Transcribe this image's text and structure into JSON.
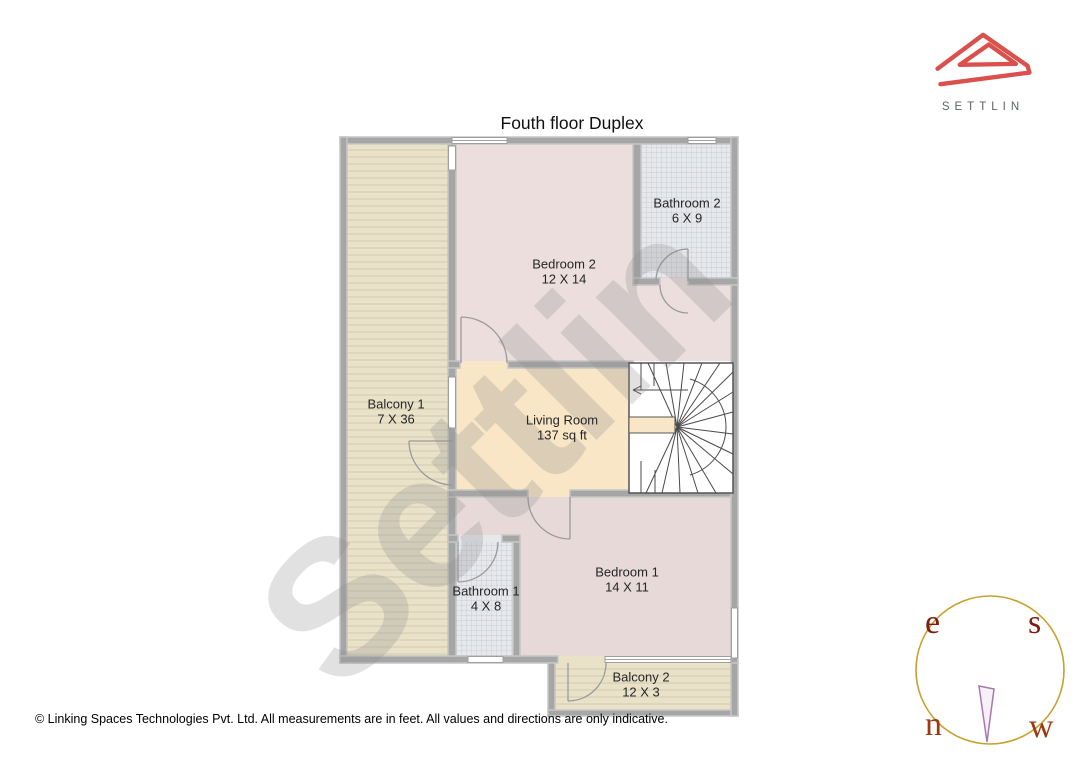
{
  "title": "Fouth floor Duplex",
  "watermark": "Settlin",
  "logo": {
    "brand": "SETTLIN"
  },
  "rooms": [
    {
      "name": "Bathroom 2",
      "dims": "6 X 9"
    },
    {
      "name": "Bedroom 2",
      "dims": "12 X 14"
    },
    {
      "name": "Balcony 1",
      "dims": "7 X 36"
    },
    {
      "name": "Living Room",
      "dims": "137 sq ft"
    },
    {
      "name": "Bathroom 1",
      "dims": "4 X 8"
    },
    {
      "name": "Bedroom 1",
      "dims": "14 X 11"
    },
    {
      "name": "Balcony 2",
      "dims": "12 X 3"
    }
  ],
  "compass": {
    "top_left": "e",
    "top_right": "s",
    "bottom_left": "n",
    "bottom_right": "w"
  },
  "footer": "© Linking Spaces Technologies Pvt. Ltd. All measurements are in feet. All values and directions are only indicative.",
  "colors": {
    "brand_red": "#d9504c",
    "logo_text_gray": "#5e6266",
    "wall_gray": "#a6a6a6",
    "bedroom_pink": "#ecdedd",
    "living_peach": "#f8e6c6",
    "balcony_beige": "#e9e2c9",
    "bathroom_gray": "#e6e8ec",
    "compass_ring_gold": "#c7a12e",
    "compass_letter_red": "#8f2a10",
    "needle_purple": "#a678ad"
  }
}
